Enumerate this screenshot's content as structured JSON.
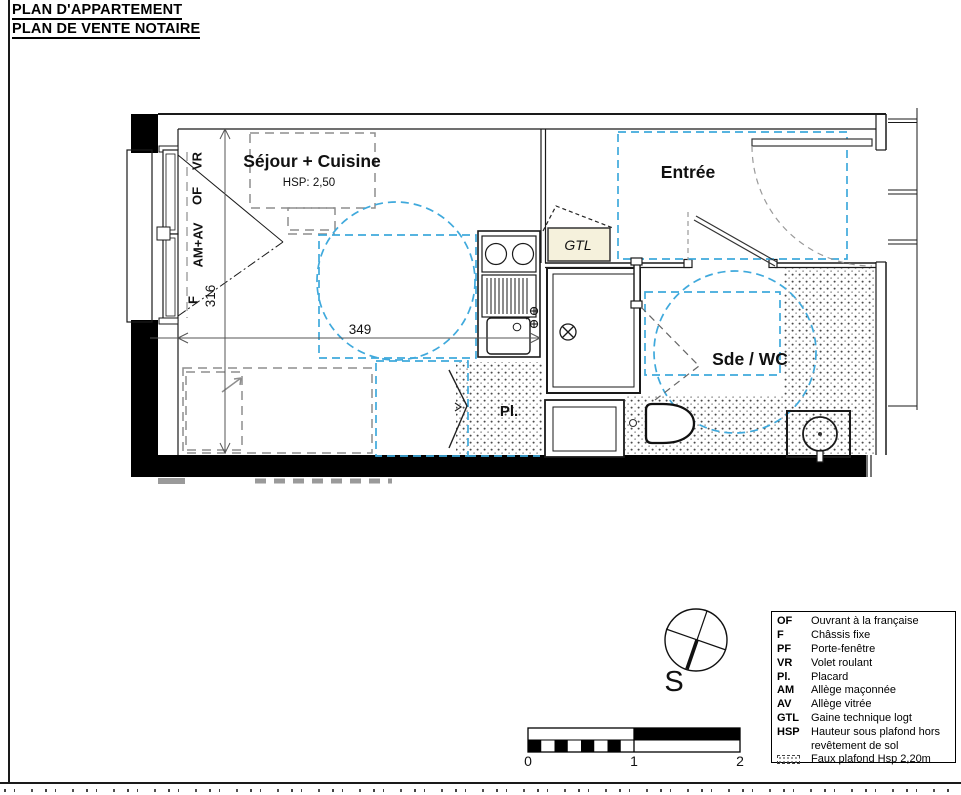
{
  "sheet": {
    "title_line1": "PLAN D'APPARTEMENT",
    "title_line2": "PLAN DE VENTE NOTAIRE"
  },
  "plan": {
    "rooms": {
      "sejour_label": "Séjour + Cuisine",
      "sejour_hsp": "HSP: 2,50",
      "entree_label": "Entrée",
      "sde_wc_label": "Sde / WC",
      "placard_label": "Pl.",
      "gtl_label": "GTL"
    },
    "window_labels": {
      "vr": "VR",
      "of": "OF",
      "am_av": "AM+AV",
      "f": "F"
    },
    "dimensions": {
      "width_cm": "349",
      "height_cm": "316"
    },
    "compass_label": "S",
    "scale_bar": {
      "tick0": "0",
      "tick1": "1",
      "tick2": "2"
    }
  },
  "legend": {
    "items": [
      {
        "key": "OF",
        "desc": "Ouvrant à la française"
      },
      {
        "key": "F",
        "desc": "Châssis fixe"
      },
      {
        "key": "PF",
        "desc": "Porte-fenêtre"
      },
      {
        "key": "VR",
        "desc": "Volet roulant"
      },
      {
        "key": "Pl.",
        "desc": "Placard"
      },
      {
        "key": "AM",
        "desc": "Allège maçonnée"
      },
      {
        "key": "AV",
        "desc": "Allège vitrée"
      },
      {
        "key": "GTL",
        "desc": "Gaine technique logt"
      },
      {
        "key": "HSP",
        "desc": "Hauteur sous plafond hors"
      },
      {
        "key": "",
        "desc": "revêtement de sol"
      },
      {
        "key": "",
        "desc": "Faux plafond Hsp 2,20m"
      }
    ]
  },
  "colors": {
    "accessibility_zone": "#3FA9DC",
    "furniture_dashed": "#8E8E8E",
    "gtl_fill": "#F5F1DC",
    "wall": "#000000",
    "hatch_dot": "#555555"
  }
}
